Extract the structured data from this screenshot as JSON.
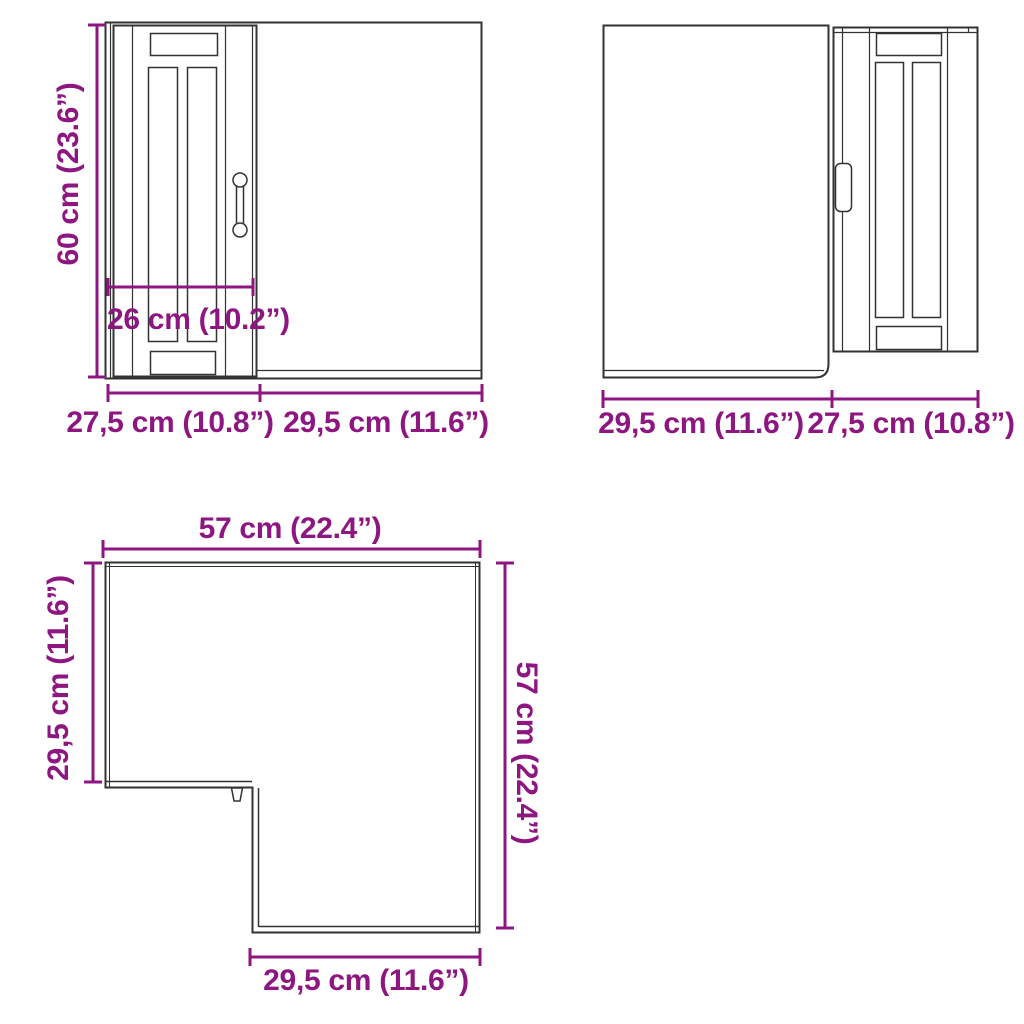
{
  "colors": {
    "dimension_text": "#8E1680",
    "drawing_line": "#333333",
    "background": "#ffffff"
  },
  "views": {
    "front_left": {
      "description": "front view, door on left side",
      "height_label": "60 cm (23.6”)",
      "door_width_label": "26 cm (10.2”)",
      "bottom_left_label": "27,5 cm (10.8”)",
      "bottom_right_label": "29,5 cm (11.6”)"
    },
    "front_right": {
      "description": "front view, door on right side",
      "bottom_left_label": "29,5 cm (11.6”)",
      "bottom_right_label": "27,5 cm (10.8”)"
    },
    "top_plan": {
      "description": "top view, L-shaped corner cabinet",
      "top_label": "57 cm (22.4”)",
      "left_label": "29,5 cm (11.6”)",
      "right_label": "57 cm (22.4”)",
      "bottom_label": "29,5 cm (11.6”)"
    }
  }
}
